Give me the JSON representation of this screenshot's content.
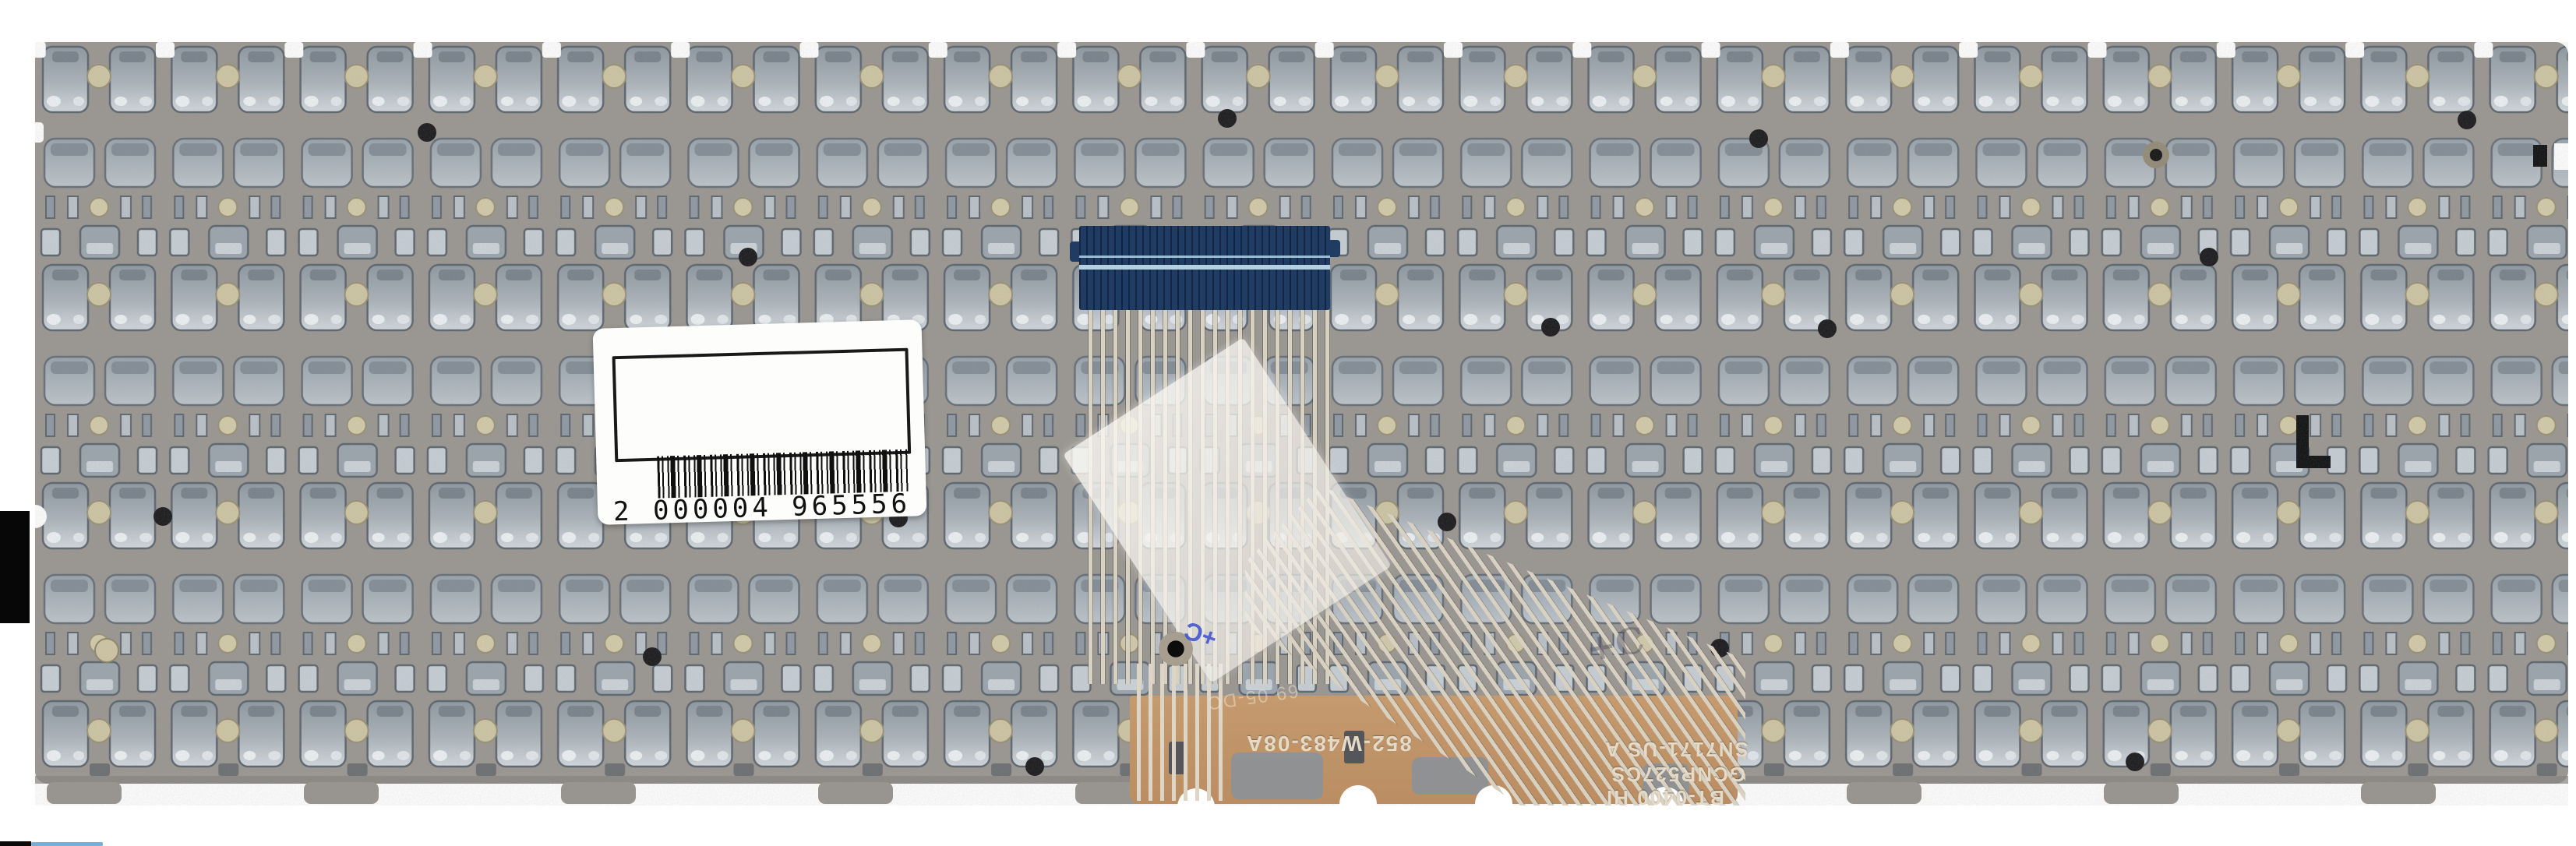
{
  "scene": {
    "description": "Back side of a laptop keyboard metal backplate with ribbon flex cable, blue stiffener and barcode sticker",
    "background_color": "#ffffff",
    "plate_color": "#999590",
    "stiffener_color": "#203c63",
    "stiffener_stripe_color": "#aecfe4",
    "flex_cable_color": "#bf9168",
    "trace_color": "#d8d0c1",
    "sticker_color": "#fdfdfb"
  },
  "sticker": {
    "barcode_value": "2 000004 965556"
  },
  "flex_markings": {
    "part_number": "852-W483-08A",
    "model_code": "SN7171-US A",
    "vendor_code": "GCNR527CS",
    "batch_code": "BT-0400 HI",
    "faint_stamp": "69 05-DC",
    "pencil_mark": "+C"
  }
}
